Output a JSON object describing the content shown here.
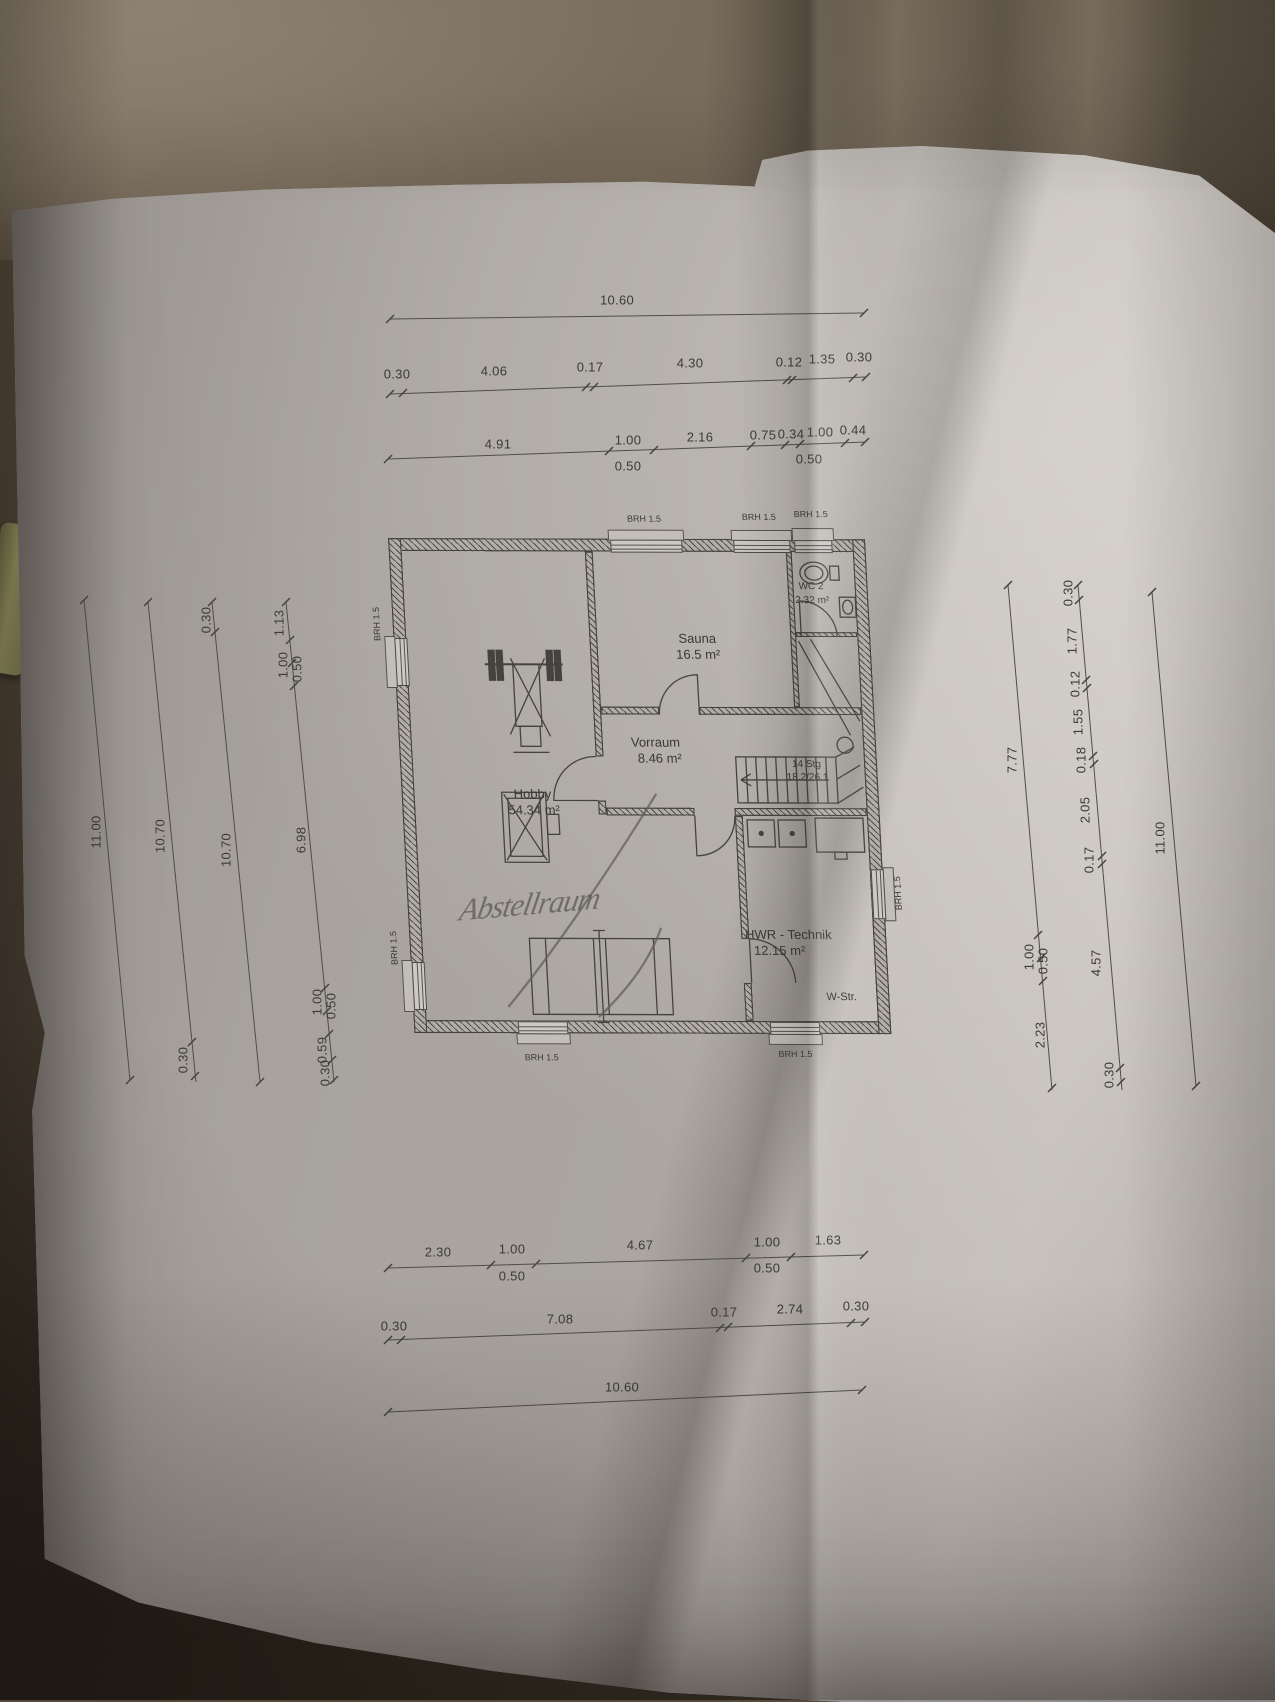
{
  "rooms": [
    {
      "name": "Sauna",
      "area": "16.5 m²"
    },
    {
      "name": "WC 2",
      "area": "2.32 m²"
    },
    {
      "name": "Vorraum",
      "area": "8.46 m²"
    },
    {
      "name": "Hobby",
      "area": "54.34 m²"
    },
    {
      "name": "HWR - Technik",
      "area": "12.15 m²"
    }
  ],
  "stairs": {
    "count": "14 Stg",
    "ratio": "18.2/26.1"
  },
  "labels": {
    "brh": "BRH 1.5",
    "w_str": "W-Str.",
    "handwriting": "Abstellraum"
  },
  "dims": {
    "top1": [
      "10.60"
    ],
    "top2": [
      "0.30",
      "4.06",
      "0.17",
      "4.30",
      "0.12",
      "1.35",
      "0.30"
    ],
    "top3": [
      "4.91",
      "1.00",
      "0.50",
      "2.16",
      "0.75",
      "0.34",
      "1.00",
      "0.50",
      "0.44"
    ],
    "bottom1": [
      "2.30",
      "1.00",
      "0.50",
      "4.67",
      "1.00",
      "0.50",
      "1.63"
    ],
    "bottom2": [
      "0.30",
      "7.08",
      "0.17",
      "2.74",
      "0.30"
    ],
    "bottom3": [
      "10.60"
    ],
    "left1": [
      "11.00"
    ],
    "left2": [
      "10.70",
      "0.30"
    ],
    "left3": [
      "0.30",
      "10.70"
    ],
    "left4": [
      "1.13",
      "1.00",
      "0.50",
      "6.98",
      "1.00",
      "0.50",
      "0.59",
      "0.30"
    ],
    "right1": [
      "7.77",
      "1.00",
      "0.50",
      "2.23"
    ],
    "right2": [
      "0.30",
      "1.77",
      "0.12",
      "1.55",
      "0.18",
      "2.05",
      "0.17",
      "4.57",
      "0.30"
    ],
    "right3": [
      "11.00"
    ]
  },
  "colors": {
    "paper": "#b1aca7",
    "ink": "#3c3a37",
    "pencil_mark": "#5d5a54",
    "fabric": "#7a6e5e"
  }
}
